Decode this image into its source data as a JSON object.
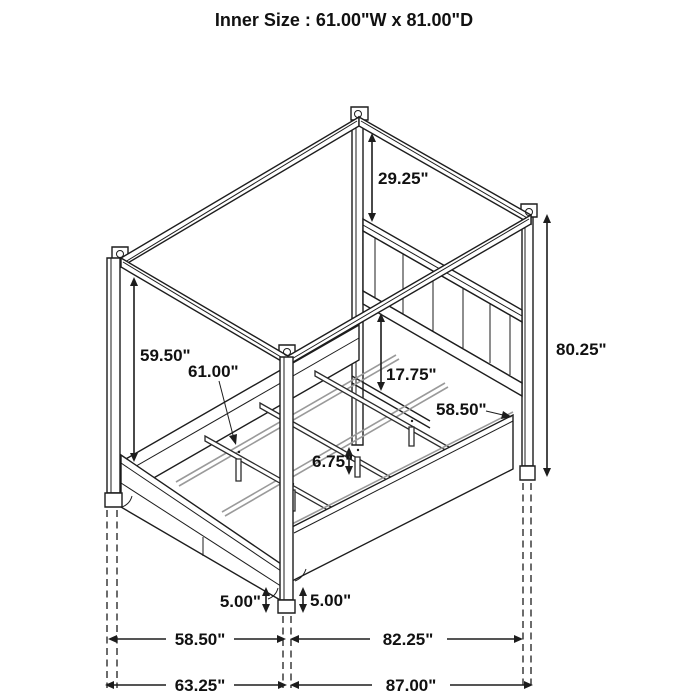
{
  "title": "Inner Size : 61.00\"W x 81.00\"D",
  "diagram": {
    "type": "furniture-dimension-diagram",
    "subject": "four-poster canopy storage bed, isometric line drawing",
    "dimensions": {
      "canopy_to_headboard": "29.25\"",
      "overall_height": "80.25\"",
      "canopy_underside_height": "59.50\"",
      "inner_width": "61.00\"",
      "headboard_above_platform": "17.75\"",
      "platform_width": "58.50\"",
      "slat_leg_height": "6.75\"",
      "clearance_foot_left": "5.00\"",
      "clearance_foot_right": "5.00\"",
      "footprint_width_inner": "58.50\"",
      "footprint_depth_inner": "82.25\"",
      "footprint_width_overall": "63.25\"",
      "footprint_depth_overall": "87.00\""
    }
  }
}
